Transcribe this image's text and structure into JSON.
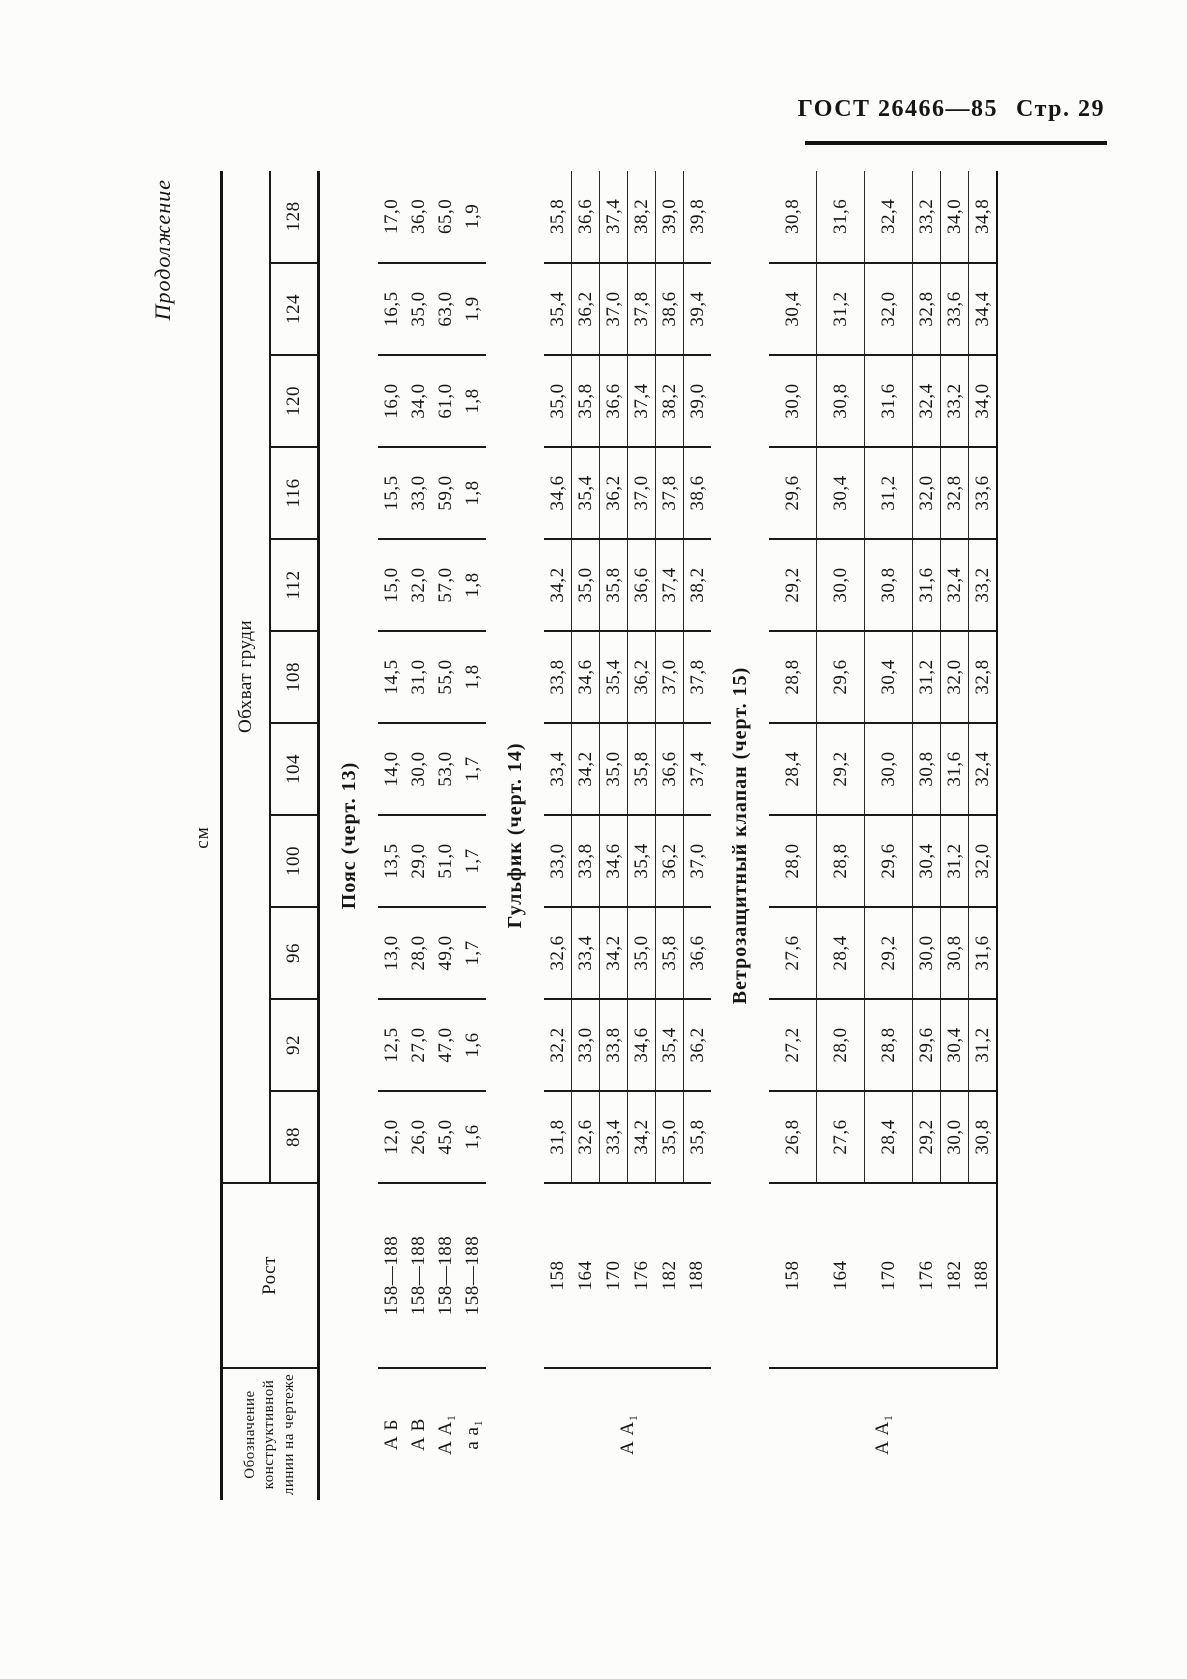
{
  "header": {
    "standard": "ГОСТ 26466—85",
    "page": "Стр. 29"
  },
  "table": {
    "continuation": "Продолжение",
    "units": "см",
    "col1_header": "Обозначение конструктивной линии на чертеже",
    "rost_header": "Рост",
    "chest_header": "Обхват груди",
    "sizes": [
      "88",
      "92",
      "96",
      "100",
      "104",
      "108",
      "112",
      "116",
      "120",
      "124",
      "128"
    ],
    "sections": [
      {
        "title": "Пояс (черт. 13)",
        "merged_label": null,
        "row_separators": false,
        "rows": [
          {
            "label": "А Б",
            "rost": "158—188",
            "values": [
              "12,0",
              "12,5",
              "13,0",
              "13,5",
              "14,0",
              "14,5",
              "15,0",
              "15,5",
              "16,0",
              "16,5",
              "17,0"
            ]
          },
          {
            "label": "А В",
            "rost": "158—188",
            "values": [
              "26,0",
              "27,0",
              "28,0",
              "29,0",
              "30,0",
              "31,0",
              "32,0",
              "33,0",
              "34,0",
              "35,0",
              "36,0"
            ]
          },
          {
            "label": "А А₁",
            "rost": "158—188",
            "values": [
              "45,0",
              "47,0",
              "49,0",
              "51,0",
              "53,0",
              "55,0",
              "57,0",
              "59,0",
              "61,0",
              "63,0",
              "65,0"
            ]
          },
          {
            "label": "а а₁",
            "rost": "158—188",
            "values": [
              "1,6",
              "1,6",
              "1,7",
              "1,7",
              "1,7",
              "1,8",
              "1,8",
              "1,8",
              "1,8",
              "1,9",
              "1,9"
            ]
          }
        ]
      },
      {
        "title": "Гульфик (черт. 14)",
        "merged_label": "А А₁",
        "row_separators": true,
        "rows": [
          {
            "rost": "158",
            "values": [
              "31,8",
              "32,2",
              "32,6",
              "33,0",
              "33,4",
              "33,8",
              "34,2",
              "34,6",
              "35,0",
              "35,4",
              "35,8"
            ]
          },
          {
            "rost": "164",
            "values": [
              "32,6",
              "33,0",
              "33,4",
              "33,8",
              "34,2",
              "34,6",
              "35,0",
              "35,4",
              "35,8",
              "36,2",
              "36,6"
            ]
          },
          {
            "rost": "170",
            "values": [
              "33,4",
              "33,8",
              "34,2",
              "34,6",
              "35,0",
              "35,4",
              "35,8",
              "36,2",
              "36,6",
              "37,0",
              "37,4"
            ]
          },
          {
            "rost": "176",
            "values": [
              "34,2",
              "34,6",
              "35,0",
              "35,4",
              "35,8",
              "36,2",
              "36,6",
              "37,0",
              "37,4",
              "37,8",
              "38,2"
            ]
          },
          {
            "rost": "182",
            "values": [
              "35,0",
              "35,4",
              "35,8",
              "36,2",
              "36,6",
              "37,0",
              "37,4",
              "37,8",
              "38,2",
              "38,6",
              "39,0"
            ]
          },
          {
            "rost": "188",
            "values": [
              "35,8",
              "36,2",
              "36,6",
              "37,0",
              "37,4",
              "37,8",
              "38,2",
              "38,6",
              "39,0",
              "39,4",
              "39,8"
            ]
          }
        ]
      },
      {
        "title": "Ветрозащитный клапан (черт. 15)",
        "merged_label": "А А₁",
        "row_separators": true,
        "rows": [
          {
            "rost": "158",
            "values": [
              "26,8",
              "27,2",
              "27,6",
              "28,0",
              "28,4",
              "28,8",
              "29,2",
              "29,6",
              "30,0",
              "30,4",
              "30,8"
            ]
          },
          {
            "rost": "164",
            "values": [
              "27,6",
              "28,0",
              "28,4",
              "28,8",
              "29,2",
              "29,6",
              "30,0",
              "30,4",
              "30,8",
              "31,2",
              "31,6"
            ]
          },
          {
            "rost": "170",
            "values": [
              "28,4",
              "28,8",
              "29,2",
              "29,6",
              "30,0",
              "30,4",
              "30,8",
              "31,2",
              "31,6",
              "32,0",
              "32,4"
            ]
          },
          {
            "rost": "176",
            "values": [
              "29,2",
              "29,6",
              "30,0",
              "30,4",
              "30,8",
              "31,2",
              "31,6",
              "32,0",
              "32,4",
              "32,8",
              "33,2"
            ]
          },
          {
            "rost": "182",
            "values": [
              "30,0",
              "30,4",
              "30,8",
              "31,2",
              "31,6",
              "32,0",
              "32,4",
              "32,8",
              "33,2",
              "33,6",
              "34,0"
            ]
          },
          {
            "rost": "188",
            "values": [
              "30,8",
              "31,2",
              "31,6",
              "32,0",
              "32,4",
              "32,8",
              "33,2",
              "33,6",
              "34,0",
              "34,4",
              "34,8"
            ]
          }
        ]
      }
    ]
  }
}
